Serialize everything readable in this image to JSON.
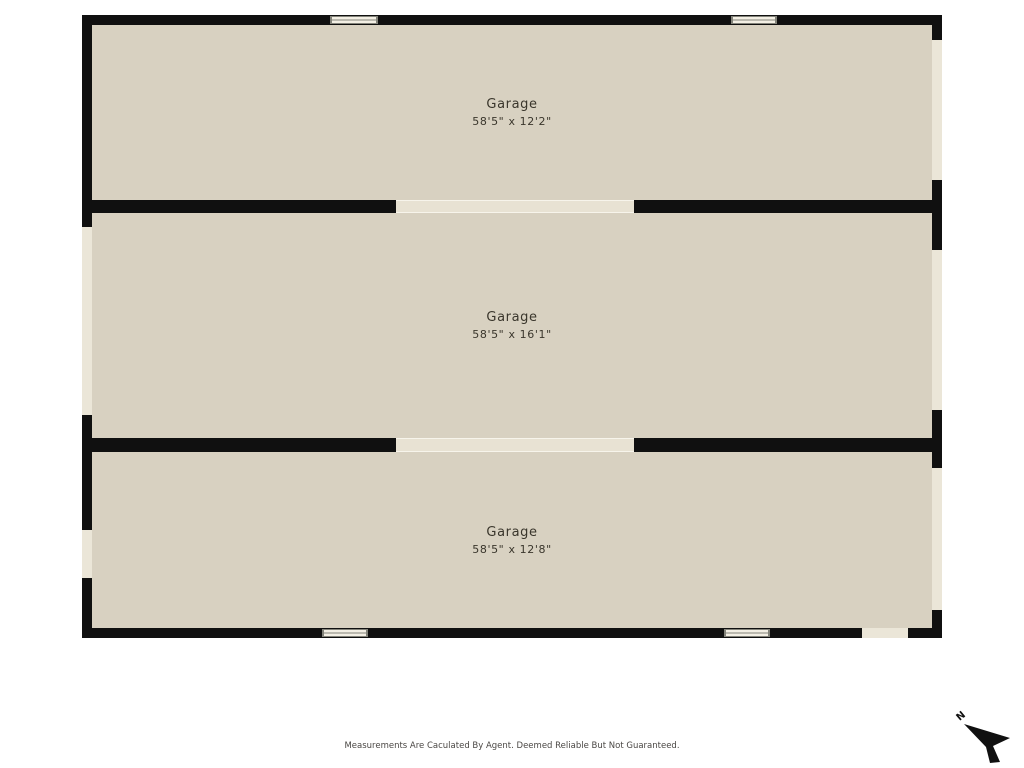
{
  "floorplan": {
    "rooms": [
      {
        "name": "Garage",
        "dimensions": "58'5\" x 12'2\""
      },
      {
        "name": "Garage",
        "dimensions": "58'5\" x 16'1\""
      },
      {
        "name": "Garage",
        "dimensions": "58'5\" x 12'8\""
      }
    ],
    "disclaimer": "Measurements Are Caculated By Agent. Deemed Reliable But Not Guaranteed.",
    "compass": {
      "label": "N"
    },
    "colors": {
      "wall": "#101010",
      "room_fill": "#d8d1c1",
      "opening_fill": "#ebe6d8",
      "divider_opening_fill": "#e8e2d3",
      "window_fill": "#f3efe4",
      "window_border": "#83837a",
      "label_text": "#3a362c",
      "disclaimer_text": "#4a4744"
    }
  }
}
